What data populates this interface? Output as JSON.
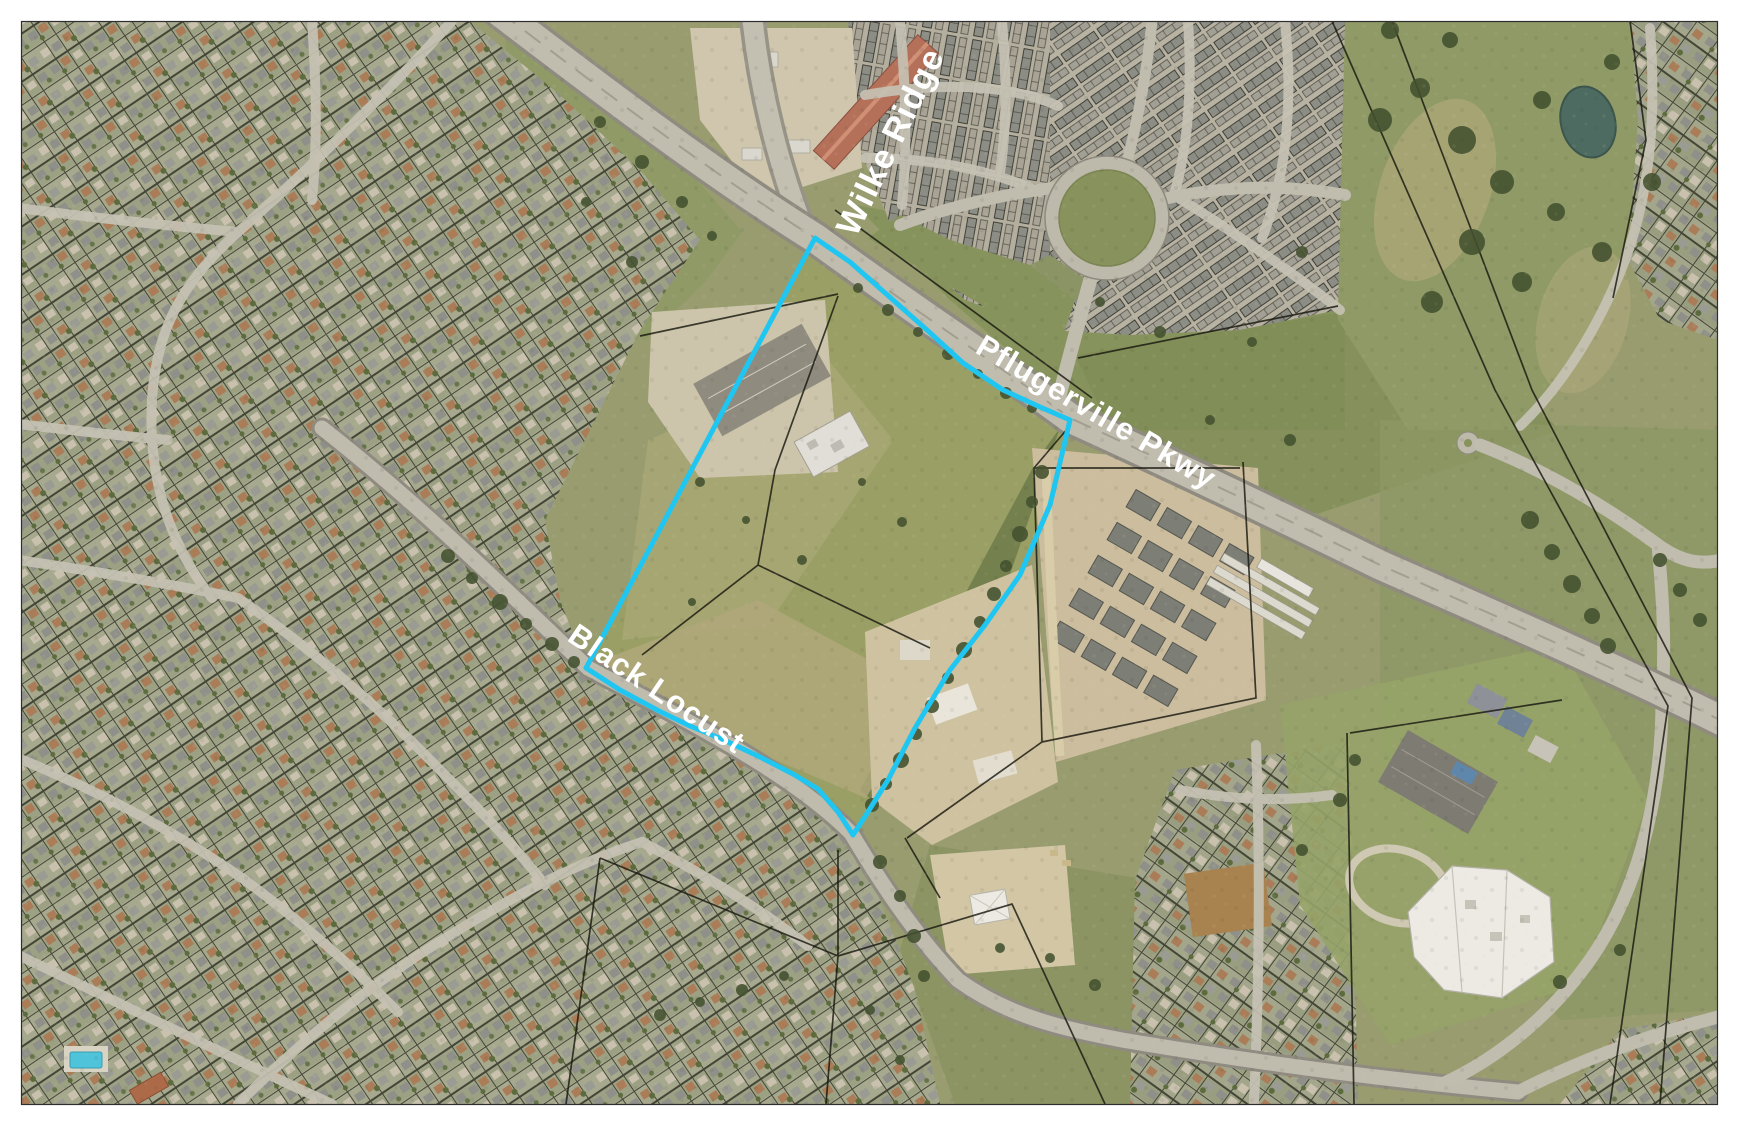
{
  "map_exhibit": {
    "street_labels": {
      "wilke_ridge": "Wilke Ridge",
      "pflugerville_pkwy": "Pflugerville Pkwy",
      "black_locust": "Black Locust"
    },
    "street_label_color": "#FFFFFF",
    "parcel_highlight_color": "#1FC6F2",
    "parcel_line_color": "#181810"
  }
}
